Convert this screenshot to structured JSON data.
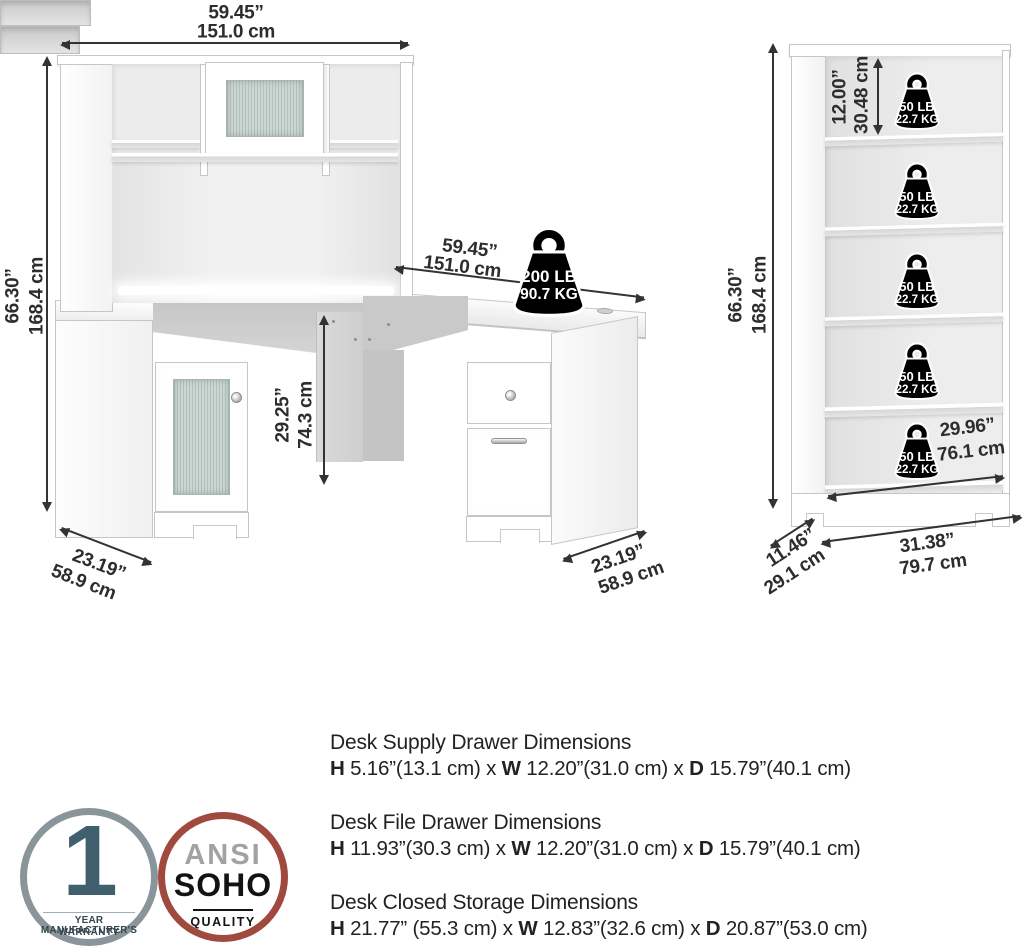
{
  "desk": {
    "hutch_width_in": "59.45”",
    "hutch_width_cm": "151.0 cm",
    "height_in": "66.30”",
    "height_cm": "168.4 cm",
    "surface_width_in": "59.45”",
    "surface_width_cm": "151.0 cm",
    "knee_height_in": "29.25”",
    "knee_height_cm": "74.3 cm",
    "left_depth_in": "23.19”",
    "left_depth_cm": "58.9 cm",
    "right_depth_in": "23.19”",
    "right_depth_cm": "58.9 cm",
    "surface_capacity_lb": "200 LB",
    "surface_capacity_kg": "90.7 KG"
  },
  "bookcase": {
    "height_in": "66.30”",
    "height_cm": "168.4 cm",
    "top_shelf_in": "12.00”",
    "top_shelf_cm": "30.48 cm",
    "shelf_capacity_lb": "50 LB",
    "shelf_capacity_kg": "22.7 KG",
    "interior_width_in": "29.96”",
    "interior_width_cm": "76.1 cm",
    "width_in": "31.38”",
    "width_cm": "79.7 cm",
    "depth_in": "11.46”",
    "depth_cm": "29.1 cm"
  },
  "specs": [
    {
      "title": "Desk Supply Drawer Dimensions",
      "h": "H",
      "h_val": " 5.16”(13.1 cm) x ",
      "w": "W",
      "w_val": " 12.20”(31.0 cm) x ",
      "d": "D",
      "d_val": " 15.79”(40.1 cm)"
    },
    {
      "title": "Desk File Drawer Dimensions",
      "h": "H",
      "h_val": " 11.93”(30.3 cm) x ",
      "w": "W",
      "w_val": " 12.20”(31.0 cm) x ",
      "d": "D",
      "d_val": " 15.79”(40.1 cm)"
    },
    {
      "title": "Desk Closed Storage Dimensions",
      "h": "H",
      "h_val": " 21.77” (55.3 cm) x ",
      "w": "W",
      "w_val": " 12.83”(32.6 cm) x ",
      "d": "D",
      "d_val": " 20.87”(53.0 cm)"
    }
  ],
  "badges": {
    "warranty": {
      "number": "1",
      "line1": "YEAR MANUFACTURER'S",
      "line2": "WARRANTY",
      "border_color": "#8a959b",
      "number_color": "#40606e",
      "text_color": "#37464f"
    },
    "quality": {
      "line1": "ANSI",
      "line2": "SOHO",
      "line3": "QUALITY",
      "border_color": "#a04a3f",
      "line1_color": "#a2a2a2",
      "text_color": "#131313"
    }
  },
  "colors": {
    "dimension_text": "#2d2d2d",
    "arrow": "#333333",
    "weight_fill": "#000000",
    "weight_text": "#ffffff",
    "glass": "#c2cfcb"
  }
}
